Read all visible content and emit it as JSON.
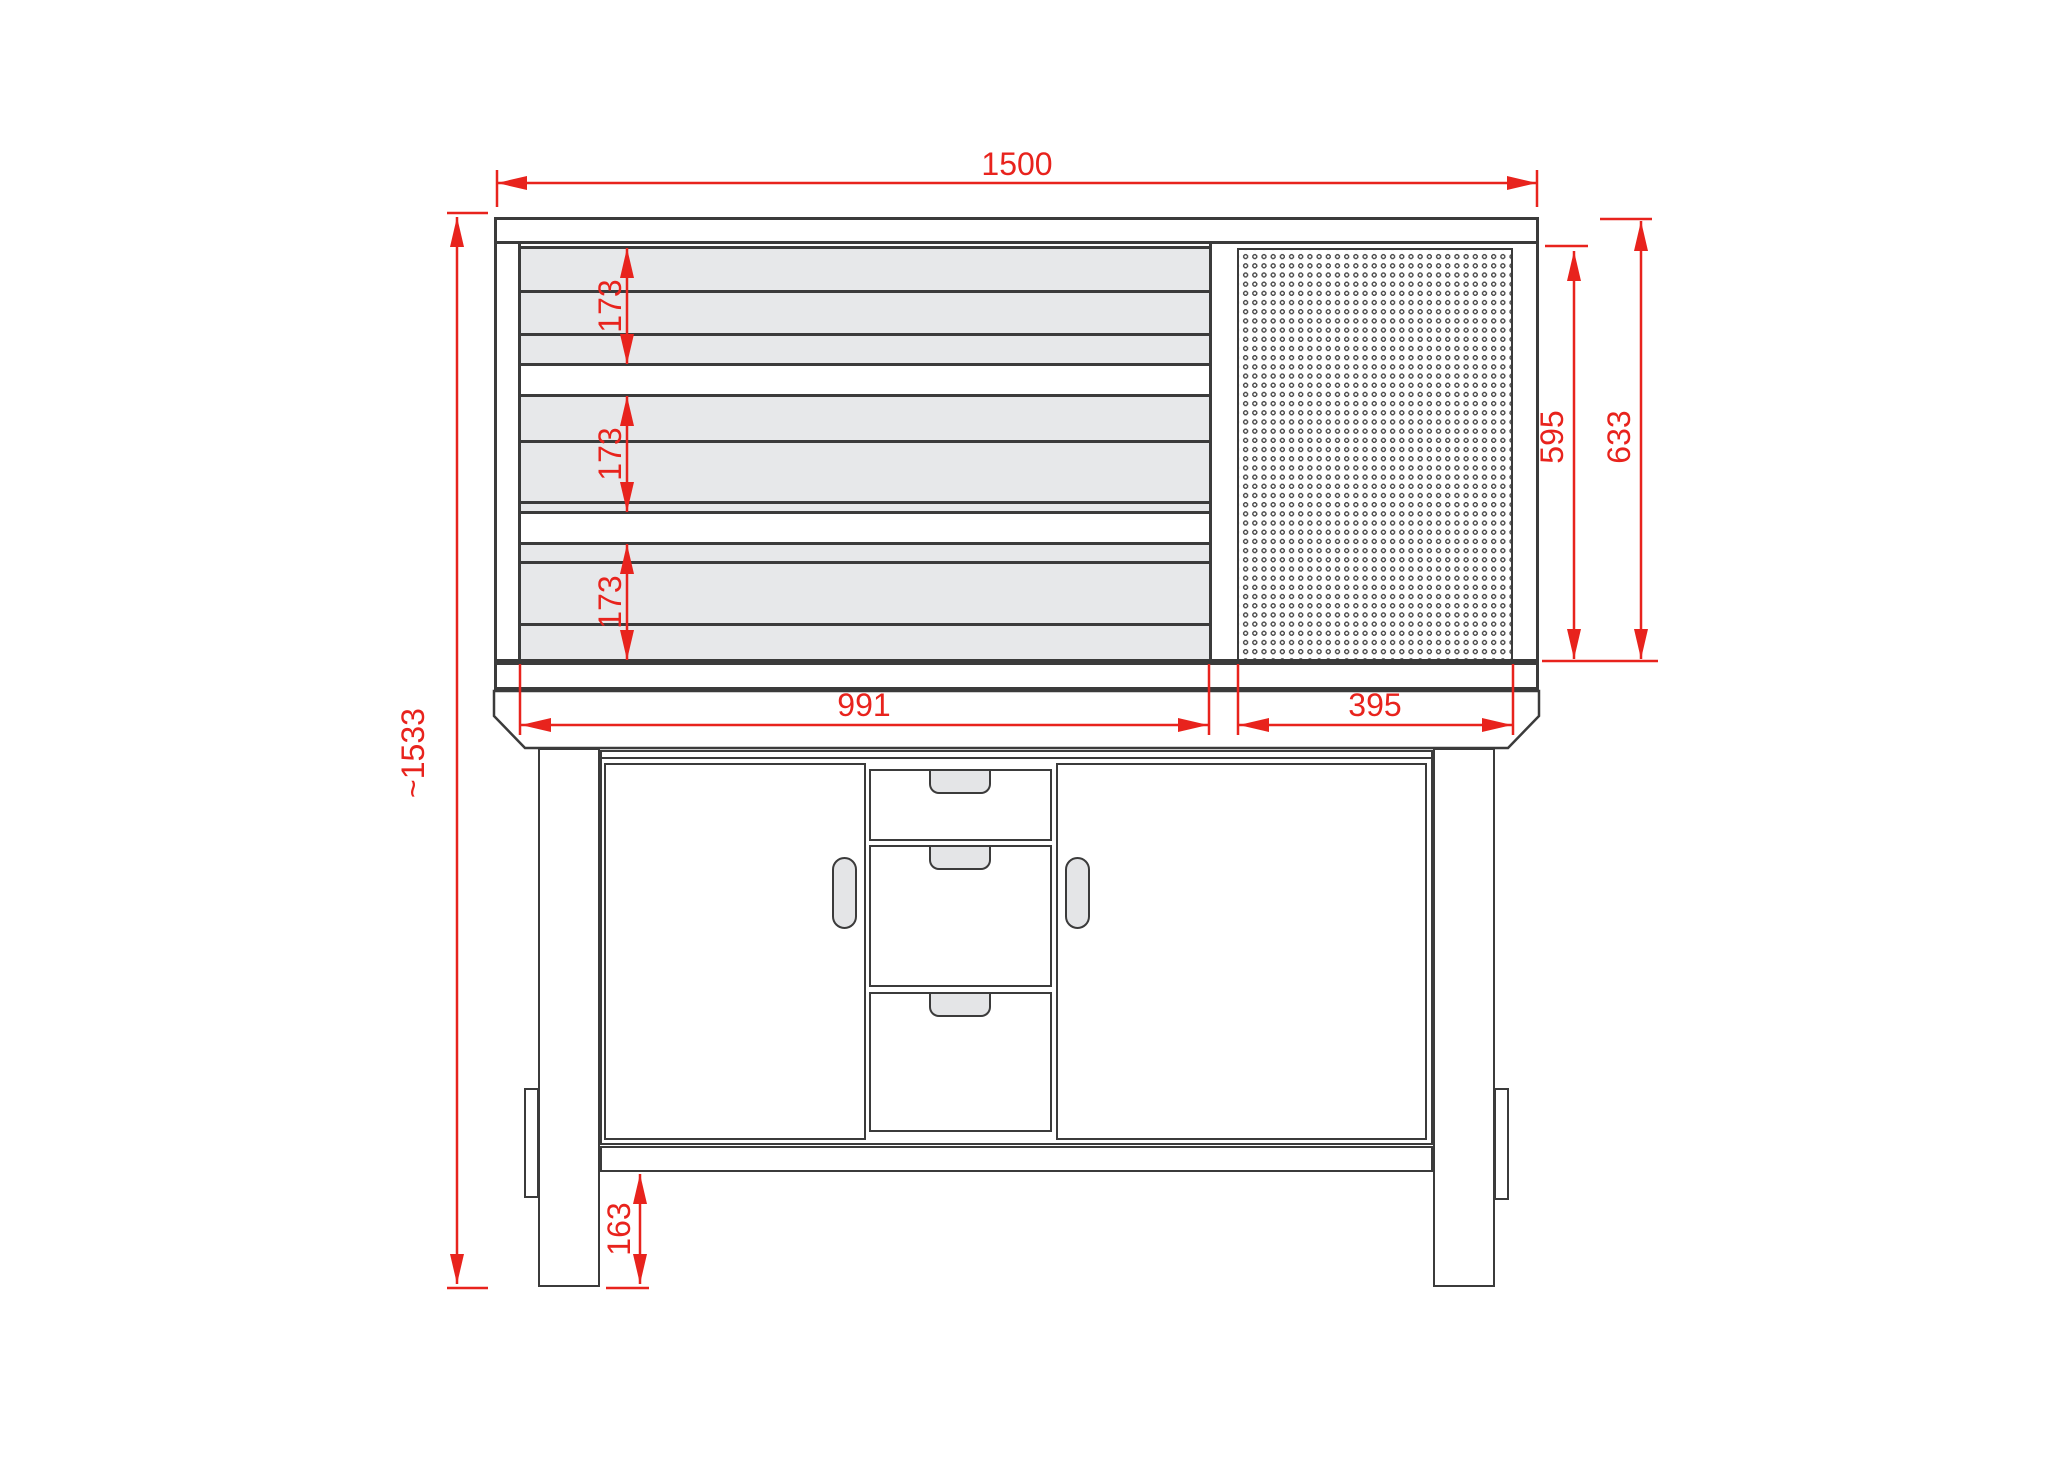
{
  "dimensions": {
    "overall_width": "1500",
    "overall_height": "~1533",
    "slat_group_top": "173",
    "slat_group_middle": "173",
    "slat_group_bottom": "173",
    "pegboard_panel_height": "595",
    "wall_unit_height": "633",
    "slat_panel_width": "991",
    "pegboard_panel_width": "395",
    "floor_clearance": "163"
  },
  "colors": {
    "dimension_red": "#e8231d",
    "outline_dark": "#3b3b3b",
    "slat_gray": "#e7e8ea",
    "handle_gray": "#e4e5e7"
  }
}
